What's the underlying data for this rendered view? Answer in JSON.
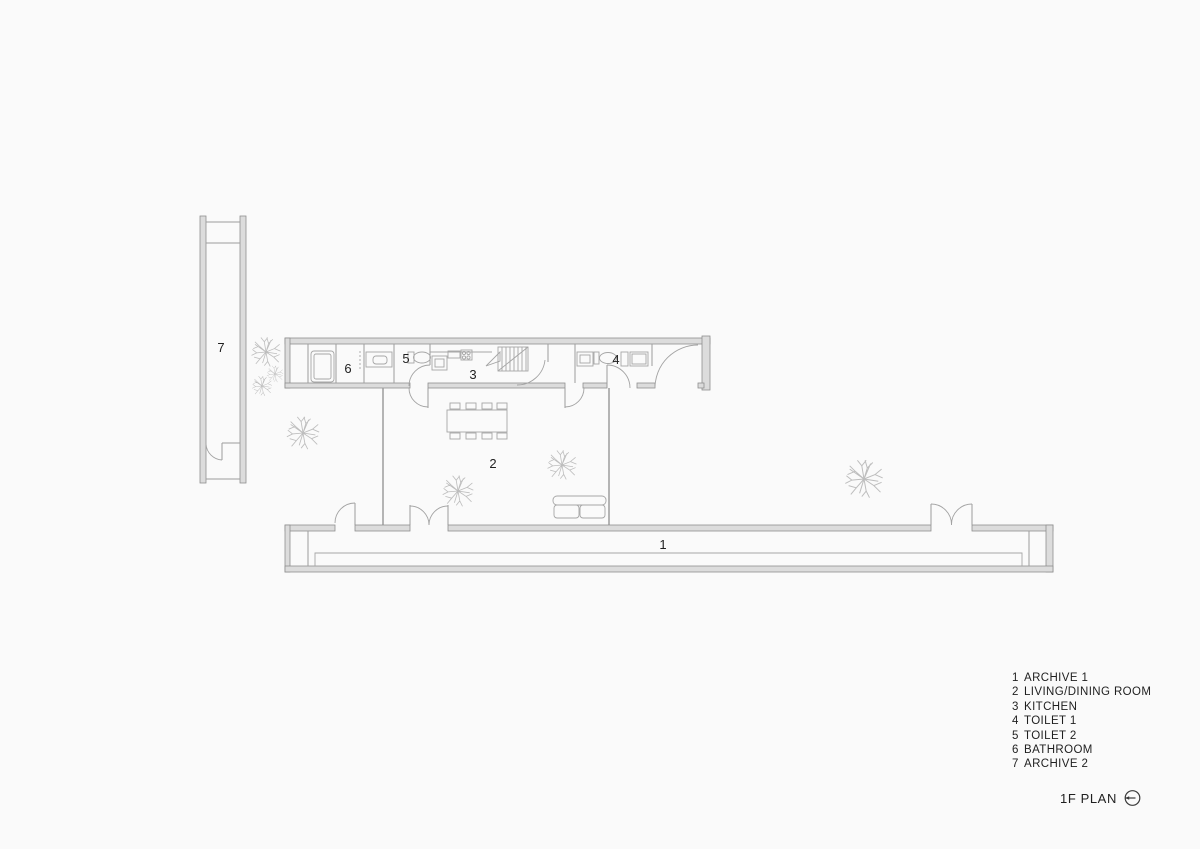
{
  "title": {
    "label": "1F PLAN"
  },
  "legend": {
    "items": [
      {
        "number": "1",
        "name": "ARCHIVE 1"
      },
      {
        "number": "2",
        "name": "LIVING/DINING ROOM"
      },
      {
        "number": "3",
        "name": "KITCHEN"
      },
      {
        "number": "4",
        "name": "TOILET 1"
      },
      {
        "number": "5",
        "name": "TOILET 2"
      },
      {
        "number": "6",
        "name": "BATHROOM"
      },
      {
        "number": "7",
        "name": "ARCHIVE 2"
      }
    ]
  },
  "plan": {
    "room_labels": {
      "archive1": "1",
      "living_dining": "2",
      "kitchen": "3",
      "toilet1": "4",
      "toilet2": "5",
      "bathroom": "6",
      "archive2": "7"
    }
  },
  "colors": {
    "background": "#fafafa",
    "wall_line": "#8f8f8f",
    "wall_fill": "#dcdcdc",
    "furniture_line": "#a6a6a6",
    "tree_line": "#bdbdbd",
    "text": "#1f1f1f"
  }
}
